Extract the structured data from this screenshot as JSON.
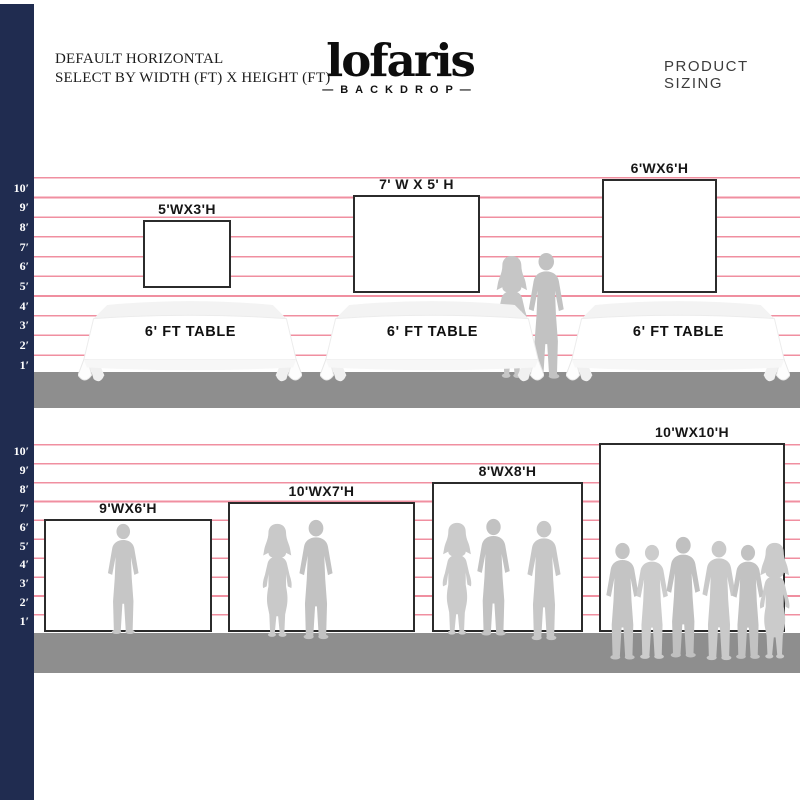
{
  "header": {
    "title_line1": "DEFAULT HORIZONTAL",
    "title_line2": "SELECT BY WIDTH (FT) X HEIGHT (FT)",
    "product_sizing": "PRODUCT SIZING"
  },
  "brand": {
    "name": "lofaris",
    "subtitle": "—BACKDROP—"
  },
  "ruler": {
    "labels": [
      "10′",
      "9′",
      "8′",
      "7′",
      "6′",
      "5′",
      "4′",
      "3′",
      "2′",
      "1′"
    ],
    "unit": "ft"
  },
  "top_section": {
    "backdrops": [
      {
        "label": "5'WX3'H",
        "width_ft": 5,
        "height_ft": 3
      },
      {
        "label": "7' W X 5' H",
        "width_ft": 7,
        "height_ft": 5
      },
      {
        "label": "6'WX6'H",
        "width_ft": 6,
        "height_ft": 6
      }
    ],
    "table_label": "6' FT TABLE",
    "table_count": 3
  },
  "bottom_section": {
    "backdrops": [
      {
        "label": "9'WX6'H",
        "width_ft": 9,
        "height_ft": 6,
        "people_count": 1
      },
      {
        "label": "10'WX7'H",
        "width_ft": 10,
        "height_ft": 7,
        "people_count": 2
      },
      {
        "label": "8'WX8'H",
        "width_ft": 8,
        "height_ft": 8,
        "people_count": 3
      },
      {
        "label": "10'WX10'H",
        "width_ft": 10,
        "height_ft": 10,
        "people_count": 6
      }
    ]
  },
  "colors": {
    "sidebar_navy": "#202c50",
    "grid_line_pink": "#f08fa0",
    "floor_gray": "#8e8e8e",
    "silhouette_gray": "#c6c6c6",
    "backdrop_border": "#2b2b2b"
  }
}
